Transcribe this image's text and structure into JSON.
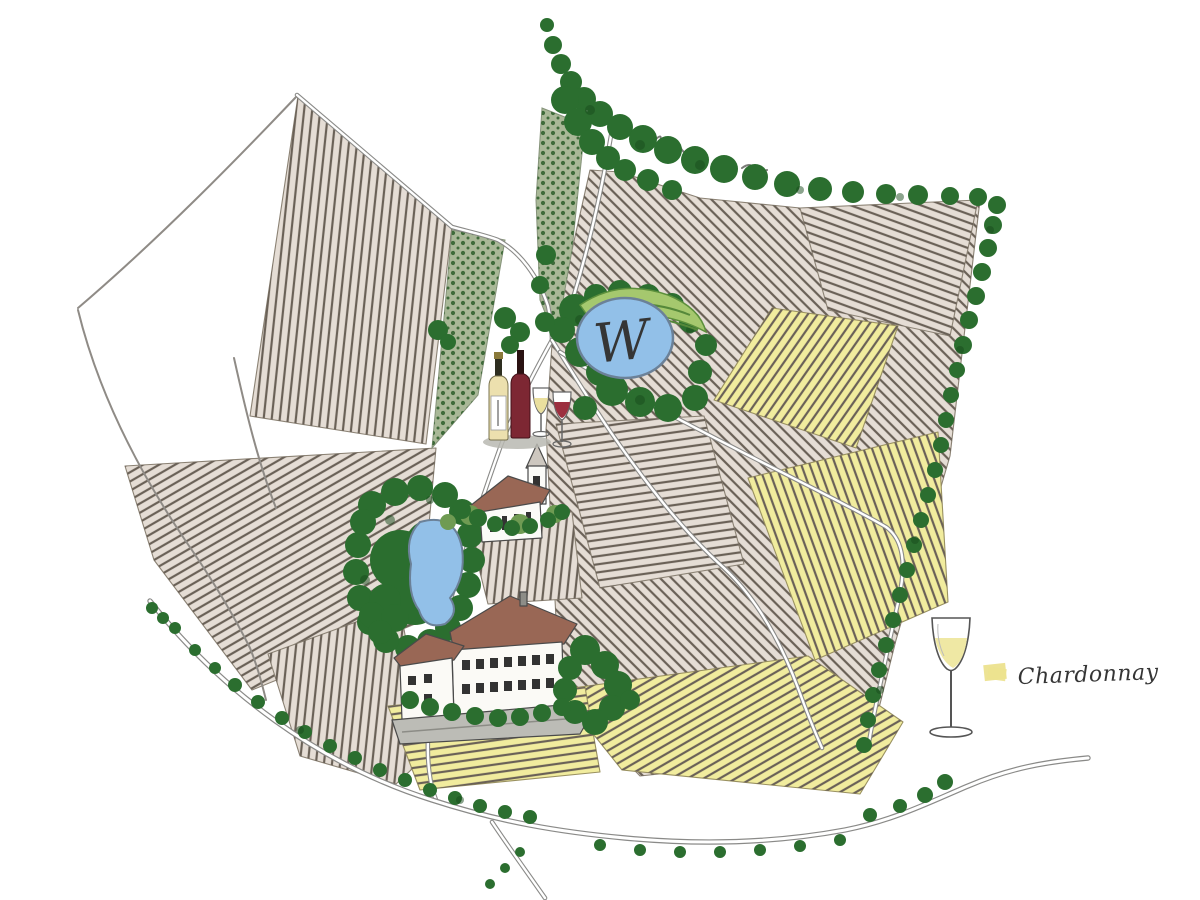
{
  "legend": {
    "items": [
      {
        "label": "Chardonnay",
        "swatch_color": "#ece28e",
        "icon": "white-wine-glass-icon"
      }
    ]
  },
  "map": {
    "pond_mark": "W",
    "features": {
      "church": "village-church",
      "manor_house": "winery-estate-buildings",
      "wine_bottles": "two-wine-bottles-with-glasses",
      "center_pond": "round-pond-with-water-mark",
      "west_pond": "woodland-pond",
      "vineyards": "hatched-vineyard-parcels",
      "chardonnay_parcels": "yellow-chardonnay-parcels",
      "orchard": "dotted-orchard-parcels",
      "forest": "forest-and-hedgerows",
      "roads": "country-roads"
    },
    "colors": {
      "background": "#ffffff",
      "field_beige": "#e5ddd5",
      "field_hatch": "#6a6157",
      "chardonnay_yellow": "#f1ec9e",
      "orchard_sage": "#a9b897",
      "orchard_dot": "#3f6b3a",
      "forest_green": "#2b6e2f",
      "forest_dark": "#174a1c",
      "meadow_green": "#a5c86e",
      "pond_blue": "#92c0e8",
      "road_gray": "#8a8a88",
      "roof_brown": "#996755",
      "wall_white": "#fbfaf6",
      "red_wine": "#7d2733",
      "white_wine": "#ece0ae"
    }
  }
}
